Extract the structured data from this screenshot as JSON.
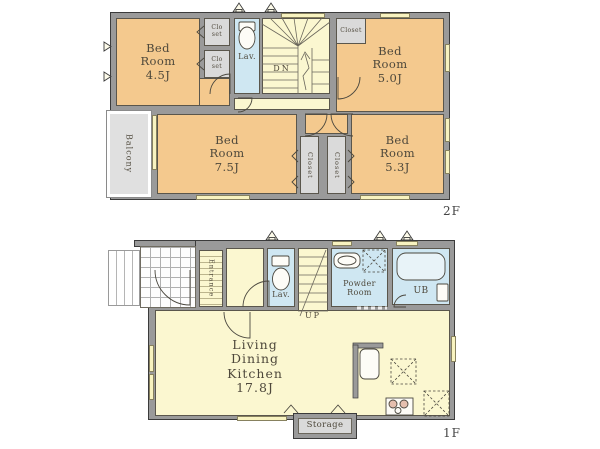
{
  "title": "House floor plan",
  "colors": {
    "wall": "#9a9a9a",
    "outline": "#3b3b3b",
    "bedroom": "#f4c98e",
    "hall": "#fbf7d0",
    "wet": "#cfe7f2",
    "closet": "#dadada",
    "balcony": "#e0e0e0",
    "window": "#f8f3c0",
    "ink": "#4e483b"
  },
  "floor2": {
    "name": "2F",
    "rooms": {
      "bed45": "Bed\nRoom\n4.5J",
      "bed50": "Bed\nRoom\n5.0J",
      "bed75": "Bed\nRoom\n7.5J",
      "bed53": "Bed\nRoom\n5.3J",
      "lav": "Lav.",
      "dn": "DN",
      "closet_a": "Clo\nset",
      "closet_b": "Clo\nset",
      "closet_c": "Closet",
      "closet_l": "Closet",
      "closet_r": "Closet",
      "balcony": "Balcony"
    }
  },
  "floor1": {
    "name": "1F",
    "rooms": {
      "ldk": "Living\nDining\nKitchen\n17.8J",
      "entrance": "Entrance",
      "lav": "Lav.",
      "up": "UP",
      "powder": "Powder\nRoom",
      "ub": "UB",
      "storage": "Storage"
    }
  },
  "icons": {
    "toilet-icon": "cistern rect + bowl ellipse",
    "bathtub-icon": "rounded rectangle tub",
    "sink-icon": "oval basin",
    "kitchen-sink-icon": "rounded rect basin",
    "stove-icon": "rect with 3 burner circles",
    "appliance-space-icon": "dashed square with X",
    "stairs-down-icon": "winder stair treads, DN",
    "stairs-up-icon": "straight stair treads, UP",
    "vent-icon": "small triangle on outer wall",
    "door-arc-icon": "quarter-circle swing",
    "folding-door-icon": "chevron marks",
    "sliding-door-icon": "white dashed line"
  }
}
